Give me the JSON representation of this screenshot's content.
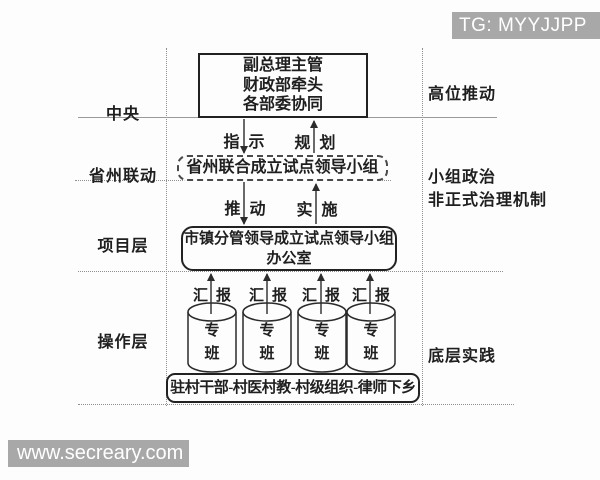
{
  "watermarks": {
    "top_right": {
      "text": "TG: MYYJJPP"
    },
    "bottom_left": {
      "text": "www.secreary.com"
    }
  },
  "colors": {
    "watermark_bg": "#a8a8a8",
    "watermark_text": "#ffffff",
    "ink": "#1f1f1f",
    "guide_line": "#8f8f8f"
  },
  "left_labels": {
    "central": "中央",
    "provincial": "省州联动",
    "project": "项目层",
    "operation": "操作层"
  },
  "right_labels": {
    "top": "高位推动",
    "middle_line1": "小组政治",
    "middle_line2": "非正式治理机制",
    "bottom": "底层实践"
  },
  "nodes": {
    "central_box": {
      "line1": "副总理主管",
      "line2": "财政部牵头",
      "line3": "各部委协同"
    },
    "provincial_box": {
      "label": "省州联合成立试点领导小组"
    },
    "project_box": {
      "line1": "市镇分管领导成立试点领导小组",
      "line2": "办公室"
    },
    "grassroots_box": {
      "label": "驻村干部-村医村教-村级组织-律师下乡"
    }
  },
  "edge_labels": {
    "instruct": [
      "指",
      "示"
    ],
    "plan": [
      "规",
      "划"
    ],
    "promote": [
      "推",
      "动"
    ],
    "implement": [
      "实",
      "施"
    ],
    "reports": [
      [
        "汇",
        "报"
      ],
      [
        "汇",
        "报"
      ],
      [
        "汇",
        "报"
      ],
      [
        "汇",
        "报"
      ]
    ]
  },
  "cylinders": [
    {
      "label": "专\n班"
    },
    {
      "label": "专\n班"
    },
    {
      "label": "专\n班"
    },
    {
      "label": "专\n班"
    }
  ]
}
